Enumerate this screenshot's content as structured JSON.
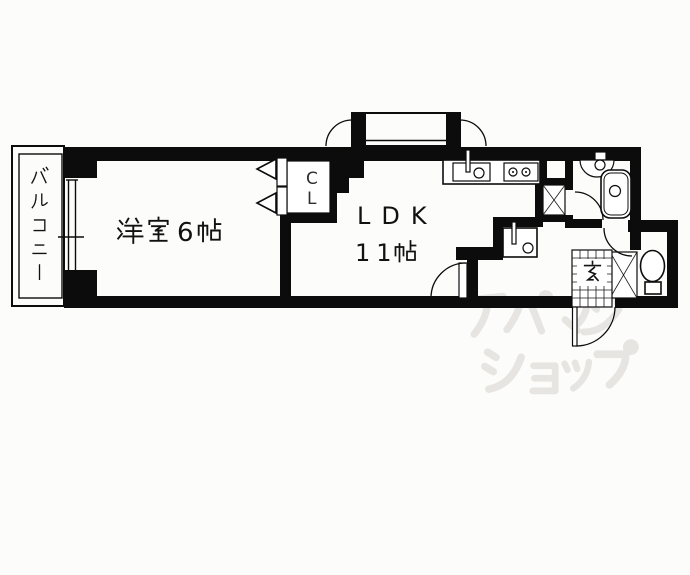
{
  "title": "間取り図 1LDK",
  "canvas": {
    "width": 690,
    "height": 575,
    "background": "#fcfcfa",
    "wall_color": "#0c0c0c",
    "watermark_color": "#e7e5e1"
  },
  "rooms": [
    {
      "id": "balcony",
      "label": "バルコニー"
    },
    {
      "id": "western_room",
      "label": "洋室6帖",
      "name": "洋室",
      "tatami": "6"
    },
    {
      "id": "ldk",
      "label": "ＬＤＫ １１帖",
      "name": "LDK",
      "tatami": "11"
    },
    {
      "id": "closet",
      "label": "CL"
    },
    {
      "id": "entrance",
      "label": "玄"
    }
  ],
  "labels": {
    "western_room": "洋室6帖",
    "room_tatami_count": "6",
    "ldk": "LDK",
    "ldk_tatami_count": "11",
    "ldk_size": "１１帖",
    "closet_chars": [
      "C",
      "L"
    ],
    "balcony": "バルコニー",
    "entrance": "玄"
  },
  "fixtures": [
    "balcony-sliding-window",
    "bay-window",
    "closet-bifold-door",
    "kitchen-counter",
    "kitchen-sink",
    "gas-stove",
    "pipe-space",
    "wash-basin",
    "bathroom-sink",
    "bathtub",
    "toilet",
    "shoe-cabinet",
    "entrance-tile",
    "entrance-door",
    "bathroom-door",
    "toilet-door",
    "ldk-door"
  ],
  "watermark": {
    "text": "アパマンショップ",
    "line1": "アパマン",
    "line2": "ショップ"
  }
}
